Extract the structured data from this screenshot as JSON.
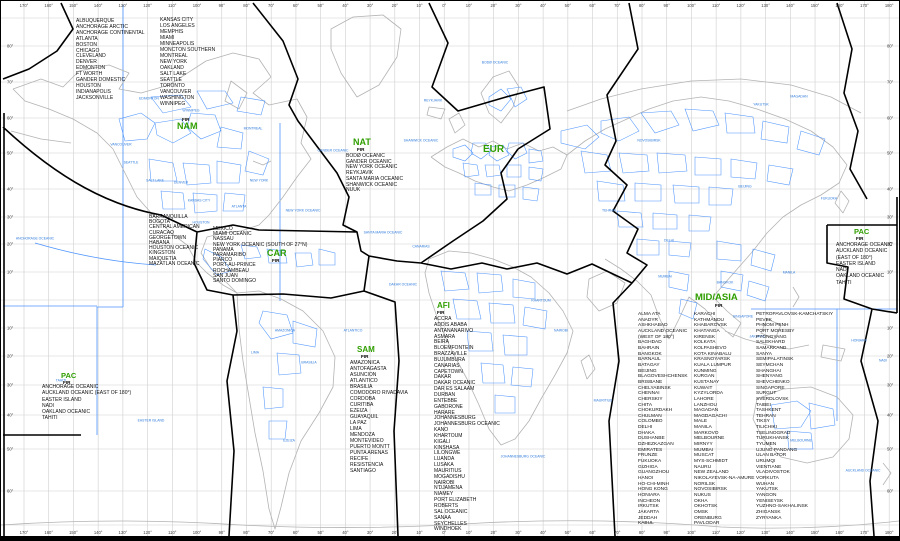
{
  "regions": {
    "nam": {
      "fir": "FIR",
      "label": "NAM",
      "cities_col1": [
        "ALBUQUERQUE",
        "ANCHORAGE ARCTIC",
        "ANCHORAGE CONTINENTAL",
        "ATLANTA",
        "BOSTON",
        "CHICAGO",
        "CLEVELAND",
        "DENVER",
        "EDMONTON",
        "FT WORTH",
        "GANDER DOMESTIC",
        "HOUSTON",
        "INDIANAPOLIS",
        "JACKSONVILLE"
      ],
      "cities_col2": [
        "KANSAS CITY",
        "LOS ANGELES",
        "MEMPHIS",
        "MIAMI",
        "MINNEAPOLIS",
        "MONCTON SOUTHERN",
        "MONTREAL",
        "NEW YORK",
        "OAKLAND",
        "SALT LAKE",
        "SEATTLE",
        "TORONTO",
        "VANCOUVER",
        "WASHINGTON",
        "WINNIPEG"
      ]
    },
    "nat": {
      "label": "NAT",
      "fir": "FIR",
      "cities": [
        "BODØ OCEANIC",
        "GANDER OCEANIC",
        "NEW YORK OCEANIC",
        "REYKJAVIK",
        "SANTA MARIA OCEANIC",
        "SHANWICK OCEANIC",
        "NUUK"
      ]
    },
    "eur": {
      "label": "EUR"
    },
    "car": {
      "label": "CAR",
      "fir": "FIR",
      "cities_west": [
        "BARRANQUILLA",
        "BOGOTA",
        "CENTRAL AMERICAN",
        "CURACAO",
        "GEORGETOWN",
        "HABANA",
        "HOUSTON OCEANIC",
        "KINGSTON",
        "MAIQUETIA",
        "MAZATLAN OCEANIC"
      ],
      "cities_east": [
        "MEXICO",
        "MIAMI OCEANIC",
        "NASSAU",
        "NEW YORK OCEANIC (SOUTH OF 27°N)",
        "PANAMA",
        "PARAMARIBO",
        "PIARCO",
        "PORT-AU-PRINCE",
        "ROCHAMBEAU",
        "SAN JUAN",
        "SANTO DOMINGO"
      ]
    },
    "sam": {
      "label": "SAM",
      "fir": "FIR",
      "cities": [
        "AMAZONICA",
        "ANTOFAGASTA",
        "ASUNCION",
        "ATLANTICO",
        "BRASILIA",
        "COMODORO RIVADAVIA",
        "CORDOBA",
        "CURITIBA",
        "EZEIZA",
        "GUAYAQUIL",
        "LA PAZ",
        "LIMA",
        "MENDOZA",
        "MONTEVIDEO",
        "PUERTO MONTT",
        "PUNTA ARENAS",
        "RECIFE",
        "RESISTENCIA",
        "SANTIAGO"
      ]
    },
    "afi": {
      "label": "AFI",
      "fir": "FIR",
      "cities": [
        "ACCRA",
        "ADDIS ABABA",
        "ANTANANARIVO",
        "ASMARA",
        "BEIRA",
        "BLOEMFONTEIN",
        "BRAZZAVILLE",
        "BUJUMBURA",
        "CANARIAS",
        "CAPETOWN",
        "DAKAR",
        "DAKAR OCEANIC",
        "DAR ES SALAAM",
        "DURBAN",
        "ENTEBBE",
        "GABORONE",
        "HARARE",
        "JOHANNESBURG",
        "JOHANNESBURG OCEANIC",
        "KANO",
        "KHARTOUM",
        "KIGALI",
        "KINSHASA",
        "LILONGWE",
        "LUANDA",
        "LUSAKA",
        "MAURITIUS",
        "MOGADISHU",
        "NAIROBI",
        "N'DJAMENA",
        "NIAMEY",
        "PORT ELIZABETH",
        "ROBERTS",
        "SAL OCEANIC",
        "SANAA",
        "SEYCHELLES",
        "WINDHOEK"
      ]
    },
    "mid_asia": {
      "label": "MID/ASIA",
      "fir": "FIR",
      "col1": [
        "ALMA ATA",
        "ANADYR",
        "ASHKHABAD",
        "AUCKLAND OCEANIC",
        "(WEST OF 180°)",
        "BAGHDAD",
        "BAHRAIN",
        "BANGKOK",
        "BARNAUL",
        "BATAGAY",
        "BEIJING",
        "BLAGOVESHCHENSK",
        "BRISBANE",
        "CHELYABINSK",
        "CHENNAI",
        "CHERSKIY",
        "CHITA",
        "CHOKURDAKH",
        "CHULMAN",
        "COLOMBO",
        "DELHI",
        "DHAKA",
        "DUSHANBE",
        "DZHEZKAZGAN",
        "EMIRATES",
        "FRUNZE",
        "FUKUOKA",
        "GIZHIGA",
        "GUANGZHOU",
        "HANOI",
        "HO-CHI-MINH",
        "HONG KONG",
        "HONIARA",
        "INCHEON",
        "IRKUTSK",
        "JAKARTA",
        "JEDDAH",
        "KABUL"
      ],
      "col2": [
        "KARACHI",
        "KATHMANDU",
        "KHABAROVSK",
        "KHATANGA",
        "KIRENSK",
        "KOLKATA",
        "KOLPASHEVO",
        "KOTA KINABALU",
        "KRASNOYARSK",
        "KUALA LUMPUR",
        "KUNMING",
        "KURGAN",
        "KUSTANAY",
        "KUWAIT",
        "KYZYLORDA",
        "LAHORE",
        "LANZHOU",
        "MAGADAN",
        "MAGDAGACHI",
        "MALE",
        "MANILA",
        "MARKOVO",
        "MELBOURNE",
        "MIRNYY",
        "MUMBAI",
        "MUSCAT",
        "MYS-SCHMIDT",
        "NAURU",
        "NEW ZEALAND",
        "NIKOLAYEVSK-NA-AMURE",
        "NORILSK",
        "NOVOSIBIRSK",
        "NUKUS",
        "OKHA",
        "OKHOTSK",
        "OMSK",
        "ORENBURG",
        "PAVLODAR"
      ],
      "col3": [
        "PETROPAVLOVSK-KAMCHATSKIY",
        "PEVEK",
        "PHNOM PENH",
        "PORT MORESBY",
        "PYONGYANG",
        "SALEKHARD",
        "SAMARKAND",
        "SANYA",
        "SEMIPALATINSK",
        "SEYMCHAN",
        "SHANGHAI",
        "SHENYANG",
        "SHEVCHENKO",
        "SINGAPORE",
        "SURGUT",
        "SVERDLOVSK",
        "TAIBEI",
        "TASHKENT",
        "TEHRAN",
        "TIKSY",
        "TILICHIKI",
        "TSELINOGRAD",
        "TURUKHANSK",
        "TYUMEN",
        "UJUNG PANDANG",
        "ULAN BATOR",
        "URUMQI",
        "VIENTIANE",
        "VLADIVOSTOK",
        "VORKUTA",
        "WUHAN",
        "YAKUTSK",
        "YANGON",
        "YENISEYSK",
        "YUZHNO-SAKHALINSK",
        "ZHIGANSK",
        "ZYRYANKA"
      ]
    },
    "pac_west": {
      "label": "PAC",
      "fir": "FIR",
      "cities": [
        "ANCHORAGE OCEANIC",
        "AUCKLAND OCEANIC (EAST OF 180°)",
        "EASTER ISLAND",
        "NADI",
        "OAKLAND OCEANIC",
        "TAHITI"
      ]
    },
    "pac_east": {
      "label": "PAC",
      "fir": "FIR",
      "cities": [
        "ANCHORAGE OCEANIC",
        "AUCKLAND OCEANIC",
        "(EAST OF 180°)",
        "EASTER ISLAND",
        "NADI",
        "OAKLAND OCEANIC",
        "TAHITI"
      ]
    }
  },
  "axis": {
    "top": [
      "170°",
      "160°",
      "150°",
      "140°",
      "130°",
      "120°",
      "110°",
      "100°",
      "90°",
      "80°",
      "70°",
      "60°",
      "50°",
      "40°",
      "30°",
      "20°",
      "10°",
      "0°",
      "10°",
      "20°",
      "30°",
      "40°",
      "50°",
      "60°",
      "70°",
      "80°",
      "90°",
      "100°",
      "110°",
      "120°",
      "130°",
      "140°",
      "150°",
      "160°",
      "170°",
      "180°"
    ],
    "bottom": [
      "170°",
      "160°",
      "150°",
      "140°",
      "130°",
      "120°",
      "110°",
      "100°",
      "90°",
      "80°",
      "70°",
      "60°",
      "50°",
      "40°",
      "30°",
      "20°",
      "10°",
      "0°",
      "10°",
      "20°",
      "30°",
      "40°",
      "50°",
      "60°",
      "70°",
      "80°",
      "90°",
      "100°",
      "110°",
      "120°",
      "130°",
      "140°",
      "150°",
      "160°",
      "170°",
      "180°"
    ],
    "left": [
      {
        "t": "80°",
        "y": 45
      },
      {
        "t": "70°",
        "y": 81
      },
      {
        "t": "60°",
        "y": 117
      },
      {
        "t": "50°",
        "y": 152
      },
      {
        "t": "40°",
        "y": 188
      },
      {
        "t": "30°",
        "y": 216
      },
      {
        "t": "20°",
        "y": 243
      },
      {
        "t": "10°",
        "y": 271
      },
      {
        "t": "10°",
        "y": 327
      },
      {
        "t": "20°",
        "y": 355
      },
      {
        "t": "30°",
        "y": 384
      },
      {
        "t": "40°",
        "y": 414
      },
      {
        "t": "50°",
        "y": 448
      },
      {
        "t": "60°",
        "y": 490
      }
    ],
    "right": [
      {
        "t": "80°",
        "y": 45
      },
      {
        "t": "70°",
        "y": 81
      },
      {
        "t": "60°",
        "y": 117
      },
      {
        "t": "50°",
        "y": 152
      },
      {
        "t": "40°",
        "y": 188
      },
      {
        "t": "30°",
        "y": 216
      },
      {
        "t": "20°",
        "y": 243
      },
      {
        "t": "10°",
        "y": 271
      },
      {
        "t": "10°",
        "y": 327
      },
      {
        "t": "20°",
        "y": 355
      },
      {
        "t": "30°",
        "y": 384
      },
      {
        "t": "40°",
        "y": 414
      },
      {
        "t": "50°",
        "y": 448
      },
      {
        "t": "60°",
        "y": 490
      }
    ]
  },
  "fir_labels": [
    {
      "t": "EDMONTON",
      "x": 148,
      "y": 98
    },
    {
      "t": "WINNIPEG",
      "x": 190,
      "y": 110
    },
    {
      "t": "MONTREAL",
      "x": 252,
      "y": 128
    },
    {
      "t": "VANCOUVER",
      "x": 120,
      "y": 144
    },
    {
      "t": "SEATTLE",
      "x": 130,
      "y": 162
    },
    {
      "t": "SALT LAKE",
      "x": 154,
      "y": 180
    },
    {
      "t": "DENVER",
      "x": 180,
      "y": 182
    },
    {
      "t": "KANSAS CITY",
      "x": 198,
      "y": 200
    },
    {
      "t": "NEW YORK",
      "x": 258,
      "y": 180
    },
    {
      "t": "ATLANTA",
      "x": 238,
      "y": 206
    },
    {
      "t": "HOUSTON",
      "x": 200,
      "y": 222
    },
    {
      "t": "GANDER OCEANIC",
      "x": 332,
      "y": 150
    },
    {
      "t": "NEW YORK OCEANIC",
      "x": 302,
      "y": 210
    },
    {
      "t": "SANTA MARIA OCEANIC",
      "x": 382,
      "y": 232
    },
    {
      "t": "ANCHORAGE OCEANIC",
      "x": 34,
      "y": 238
    },
    {
      "t": "REYKJAVIK",
      "x": 432,
      "y": 100
    },
    {
      "t": "BODØ OCEANIC",
      "x": 494,
      "y": 62
    },
    {
      "t": "SHANWICK OCEANIC",
      "x": 420,
      "y": 140
    },
    {
      "t": "CANARIAS",
      "x": 420,
      "y": 246
    },
    {
      "t": "DAKAR OCEANIC",
      "x": 402,
      "y": 284
    },
    {
      "t": "ATLANTICO",
      "x": 352,
      "y": 330
    },
    {
      "t": "AMAZONICA",
      "x": 284,
      "y": 330
    },
    {
      "t": "LIMA",
      "x": 254,
      "y": 352
    },
    {
      "t": "BRASILIA",
      "x": 308,
      "y": 362
    },
    {
      "t": "EZEIZA",
      "x": 288,
      "y": 440
    },
    {
      "t": "JOHANNESBURG OCEANIC",
      "x": 522,
      "y": 456
    },
    {
      "t": "MAURITIUS",
      "x": 602,
      "y": 400
    },
    {
      "t": "MELBOURNE",
      "x": 800,
      "y": 440
    },
    {
      "t": "AUCKLAND OCEANIC",
      "x": 862,
      "y": 470
    },
    {
      "t": "NADI",
      "x": 882,
      "y": 360
    },
    {
      "t": "TAHITI",
      "x": 60,
      "y": 380
    },
    {
      "t": "EASTER ISLAND",
      "x": 150,
      "y": 420
    },
    {
      "t": "HONIARA",
      "x": 858,
      "y": 340
    },
    {
      "t": "MAGADAN",
      "x": 798,
      "y": 96
    },
    {
      "t": "YAKUTSK",
      "x": 760,
      "y": 104
    },
    {
      "t": "NOVOSIBIRSK",
      "x": 648,
      "y": 140
    },
    {
      "t": "BEIJING",
      "x": 744,
      "y": 186
    },
    {
      "t": "FUKUOKA",
      "x": 828,
      "y": 198
    },
    {
      "t": "DELHI",
      "x": 668,
      "y": 240
    },
    {
      "t": "MUMBAI",
      "x": 664,
      "y": 276
    },
    {
      "t": "BANGKOK",
      "x": 724,
      "y": 282
    },
    {
      "t": "MANILA",
      "x": 788,
      "y": 272
    },
    {
      "t": "SINGAPORE",
      "x": 742,
      "y": 316
    },
    {
      "t": "JAKARTA",
      "x": 756,
      "y": 336
    },
    {
      "t": "TEHRAN",
      "x": 608,
      "y": 210
    },
    {
      "t": "KHARTOUM",
      "x": 540,
      "y": 300
    },
    {
      "t": "NAIROBI",
      "x": 560,
      "y": 330
    }
  ]
}
